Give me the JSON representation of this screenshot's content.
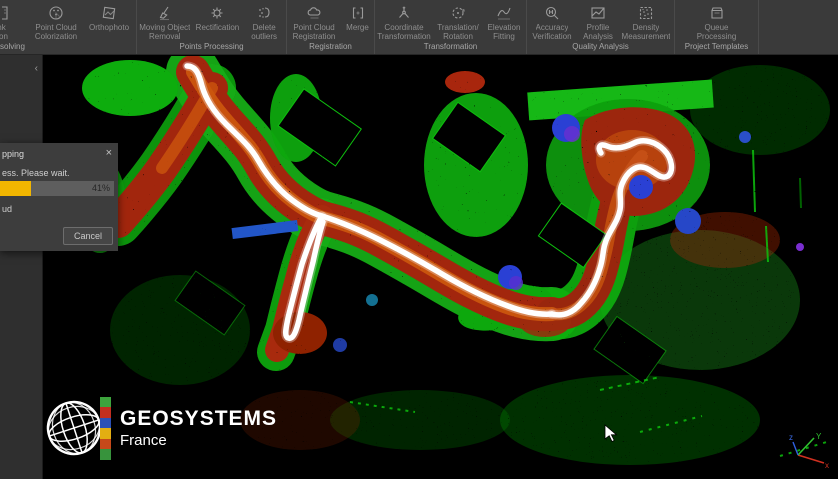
{
  "toolbar": {
    "groups": [
      {
        "label": "solving",
        "items": [
          {
            "name": "clipped-item",
            "lines": [
              "nk",
              "tion"
            ]
          },
          {
            "name": "point-cloud-colorization",
            "lines": [
              "Point Cloud",
              "Colorization"
            ]
          },
          {
            "name": "orthophoto",
            "lines": [
              "Orthophoto",
              ""
            ]
          }
        ]
      },
      {
        "label": "Points Processing",
        "items": [
          {
            "name": "moving-object-removal",
            "lines": [
              "Moving Object",
              "Removal"
            ]
          },
          {
            "name": "rectification",
            "lines": [
              "Rectification",
              ""
            ]
          },
          {
            "name": "delete-outliers",
            "lines": [
              "Delete",
              "outliers"
            ]
          }
        ]
      },
      {
        "label": "Registration",
        "items": [
          {
            "name": "point-cloud-registration",
            "lines": [
              "Point Cloud",
              "Registration"
            ]
          },
          {
            "name": "merge",
            "lines": [
              "Merge",
              ""
            ]
          }
        ]
      },
      {
        "label": "Transformation",
        "items": [
          {
            "name": "coordinate-transformation",
            "lines": [
              "Coordinate",
              "Transformation"
            ]
          },
          {
            "name": "translation-rotation",
            "lines": [
              "Translation/",
              "Rotation"
            ]
          },
          {
            "name": "elevation-fitting",
            "lines": [
              "Elevation",
              "Fitting"
            ]
          }
        ]
      },
      {
        "label": "Quality Analysis",
        "items": [
          {
            "name": "accuracy-verification",
            "lines": [
              "Accuracy",
              "Verification"
            ]
          },
          {
            "name": "profile-analysis",
            "lines": [
              "Profile",
              "Analysis"
            ]
          },
          {
            "name": "density-measurement",
            "lines": [
              "Density",
              "Measurement"
            ]
          }
        ]
      },
      {
        "label": "Project Templates",
        "items": [
          {
            "name": "queue-processing",
            "lines": [
              "Queue",
              "Processing"
            ]
          }
        ]
      }
    ]
  },
  "sidebar": {
    "collapse_chevron": "‹"
  },
  "dialog": {
    "title_fragment": "pping",
    "close_label": "×",
    "message_fragment": "ess. Please wait.",
    "progress_percent": "41%",
    "detail_fragment": "ud",
    "cancel_label": "Cancel"
  },
  "logo": {
    "brand": "GEOSYSTEMS",
    "region": "France"
  },
  "axis_gizmo": {
    "x_label": "x",
    "y_label": "Y",
    "z_label": "z"
  },
  "colors": {
    "progress_fill": "#f2b600",
    "toolbar_bg": "#3a3a3a",
    "viewport_bg": "#000000"
  }
}
